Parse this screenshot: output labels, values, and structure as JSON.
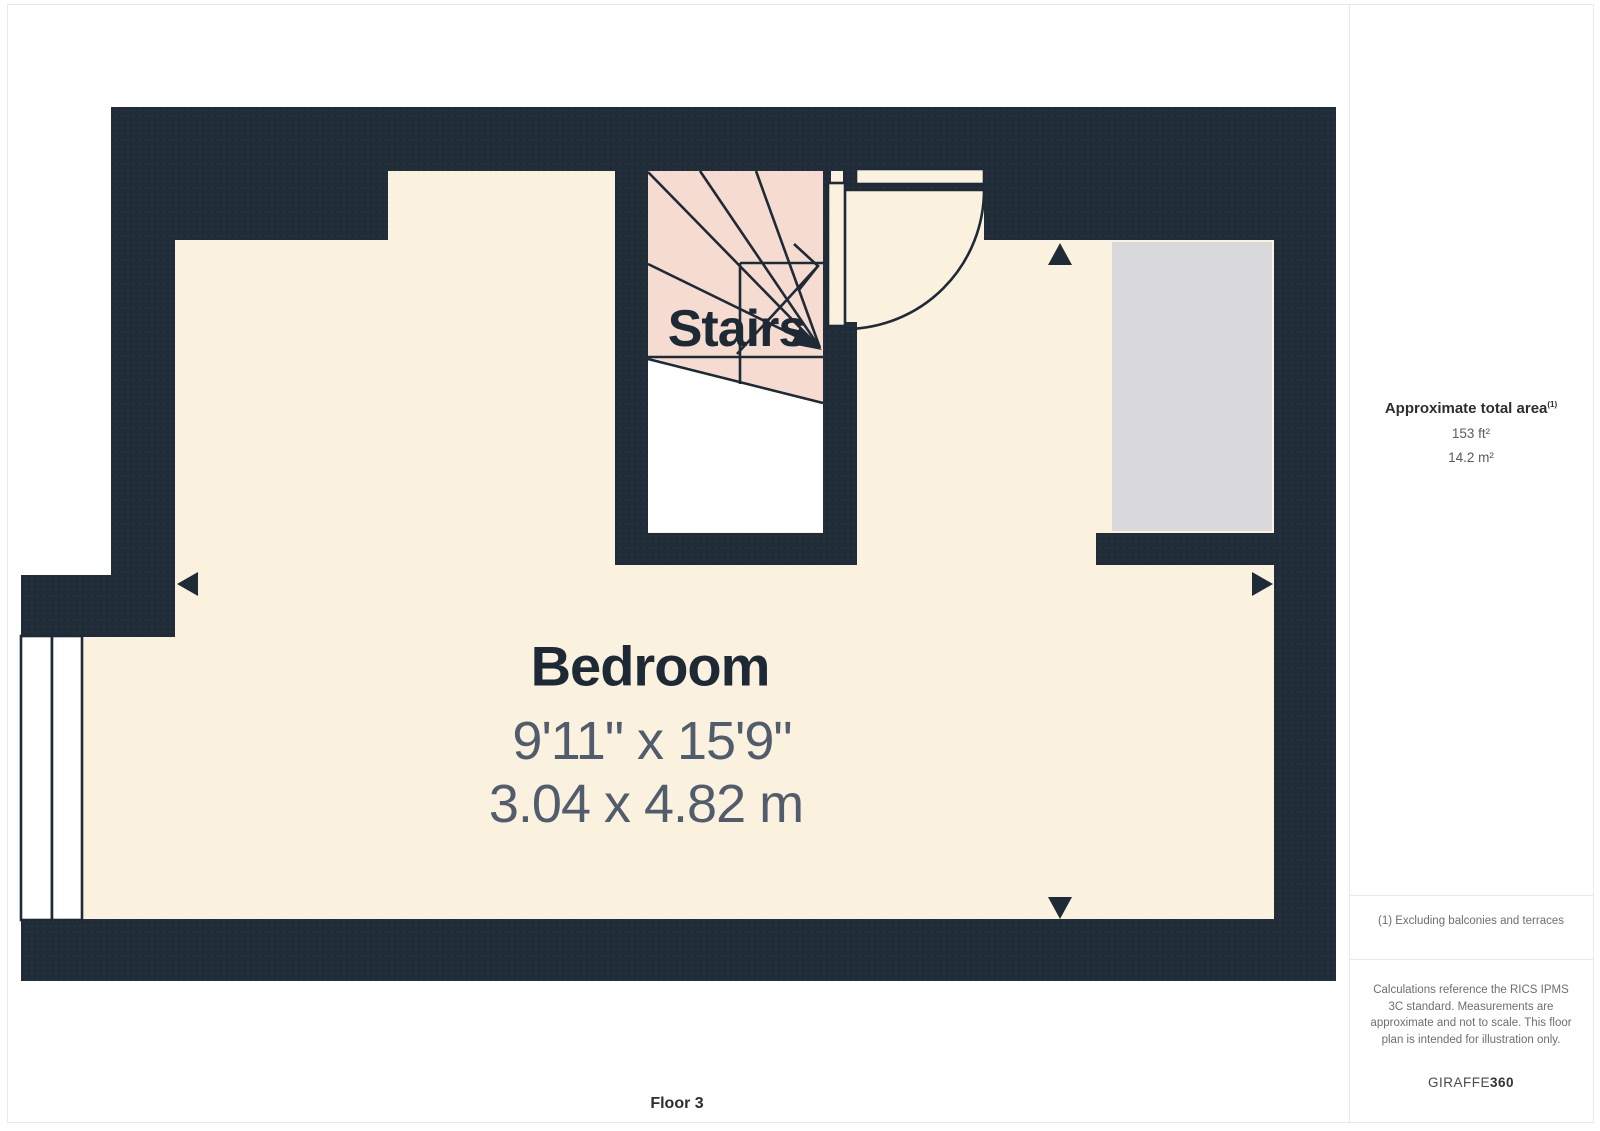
{
  "plan": {
    "stairs_label": "Stairs",
    "bedroom": {
      "name": "Bedroom",
      "dimensions_imperial": "9'11\" x 15'9\"",
      "dimensions_metric": "3.04 x 4.82 m"
    },
    "floor_label": "Floor 3"
  },
  "sidebar": {
    "area_title": "Approximate total area",
    "area_note_ref": "(1)",
    "area_imperial": "153 ft²",
    "area_metric": "14.2 m²",
    "footnote": "(1) Excluding balconies and terraces",
    "disclaimer": "Calculations reference the RICS IPMS 3C standard. Measurements are approximate and not to scale. This floor plan is intended for illustration only.",
    "brand_regular": "GIRAFFE",
    "brand_bold": "360"
  },
  "colors": {
    "wall": "#212c39",
    "room_fill": "#faf1de",
    "stairs_fill": "#f6dcd0",
    "reduced_headroom_fill": "#d9d9db",
    "line": "#1f2a37",
    "dimension_text": "#515d6c",
    "sidebar_text": "#6e6e6e"
  }
}
